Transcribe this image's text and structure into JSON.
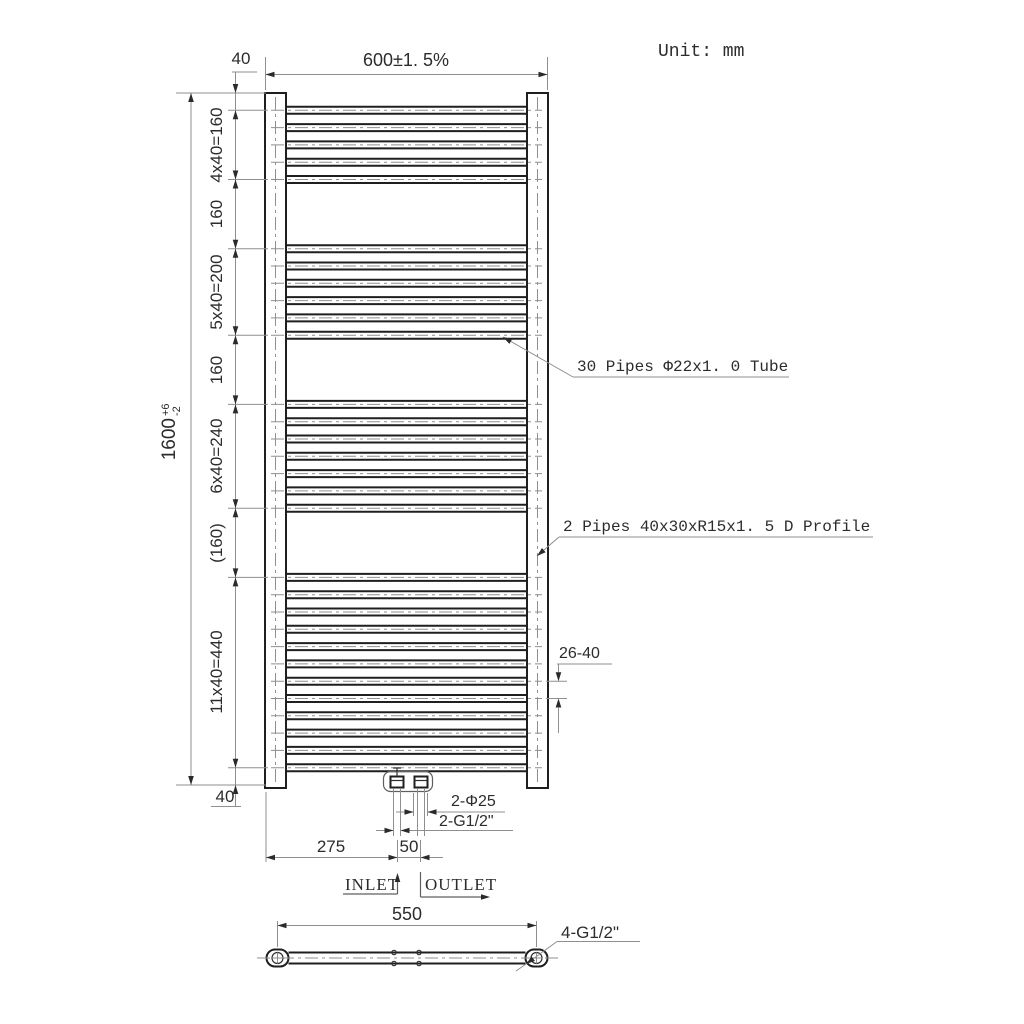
{
  "unit_note": "Unit: mm",
  "front_view": {
    "width_dim": "600±1. 5%",
    "top_offset_dim": "40",
    "bottom_offset_dim": "40",
    "overall_height": {
      "value": "1600",
      "tol_plus": "+6",
      "tol_minus": "-2"
    },
    "height_segments": [
      {
        "label": "4x40=160",
        "mm": 160
      },
      {
        "label": "160",
        "mm": 160
      },
      {
        "label": "5x40=200",
        "mm": 200
      },
      {
        "label": "160",
        "mm": 160
      },
      {
        "label": "6x40=240",
        "mm": 240
      },
      {
        "label": "(160)",
        "mm": 160
      },
      {
        "label": "11x40=440",
        "mm": 440
      }
    ],
    "pipe_groups": [
      5,
      6,
      7,
      12
    ],
    "pipe_spacing_dim": "26-40",
    "annotations": {
      "tubes": "30 Pipes Φ22x1. 0 Tube",
      "profiles": "2 Pipes 40x30xR15x1. 5 D Profile"
    },
    "connections": {
      "holes_dim": "2-Φ25",
      "thread_dim": "2-G1/2\"",
      "inlet_offset_dim": "275",
      "inlet_outlet_spacing_dim": "50",
      "inlet_label": "INLET",
      "outlet_label": "OUTLET"
    }
  },
  "bottom_view": {
    "centers_dim": "550",
    "thread_dim": "4-G1/2\""
  },
  "colors": {
    "object_line": "#1f1f1f",
    "dimension_line": "#8f8f8f",
    "text": "#2c2c2c",
    "background": "#ffffff"
  }
}
